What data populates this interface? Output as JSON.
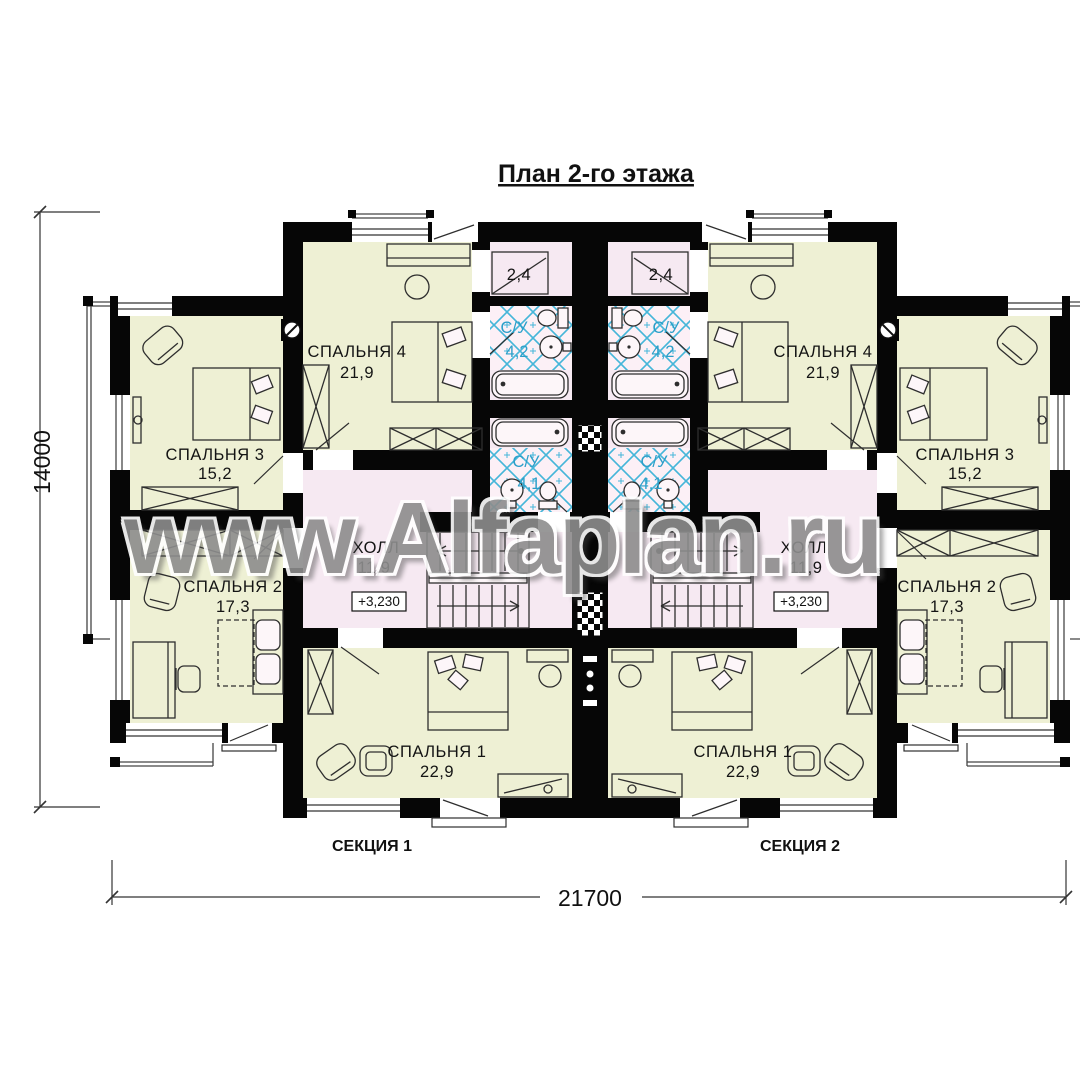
{
  "title": "План 2-го этажа",
  "watermark": "www.Alfaplan.ru",
  "dimensions": {
    "overall_width": "21700",
    "overall_height": "14000"
  },
  "elevation_mark": "+3,230",
  "section_labels": {
    "left": "СЕКЦИЯ 1",
    "right": "СЕКЦИЯ 2"
  },
  "rooms": {
    "bedroom1": {
      "name": "СПАЛЬНЯ 1",
      "area": "22,9"
    },
    "bedroom2": {
      "name": "СПАЛЬНЯ 2",
      "area": "17,3"
    },
    "bedroom3": {
      "name": "СПАЛЬНЯ 3",
      "area": "15,2"
    },
    "bedroom4": {
      "name": "СПАЛЬНЯ 4",
      "area": "21,9"
    },
    "hall": {
      "name": "ХОЛЛ",
      "area": "11,9"
    },
    "bath_upper": {
      "name": "С/У",
      "area": "4,2"
    },
    "bath_lower": {
      "name": "С/У",
      "area": "4,1"
    },
    "closet": {
      "area": "2,4"
    }
  },
  "colors": {
    "bedroom_fill": "#eef0d4",
    "hall_fill": "#f6e9f2",
    "tile_bg": "#fcf0f6",
    "tile_line": "#45b6d9",
    "bath_text": "#2b9fc9",
    "wall": "#060606",
    "watermark_gray": "#8d8d8d"
  }
}
